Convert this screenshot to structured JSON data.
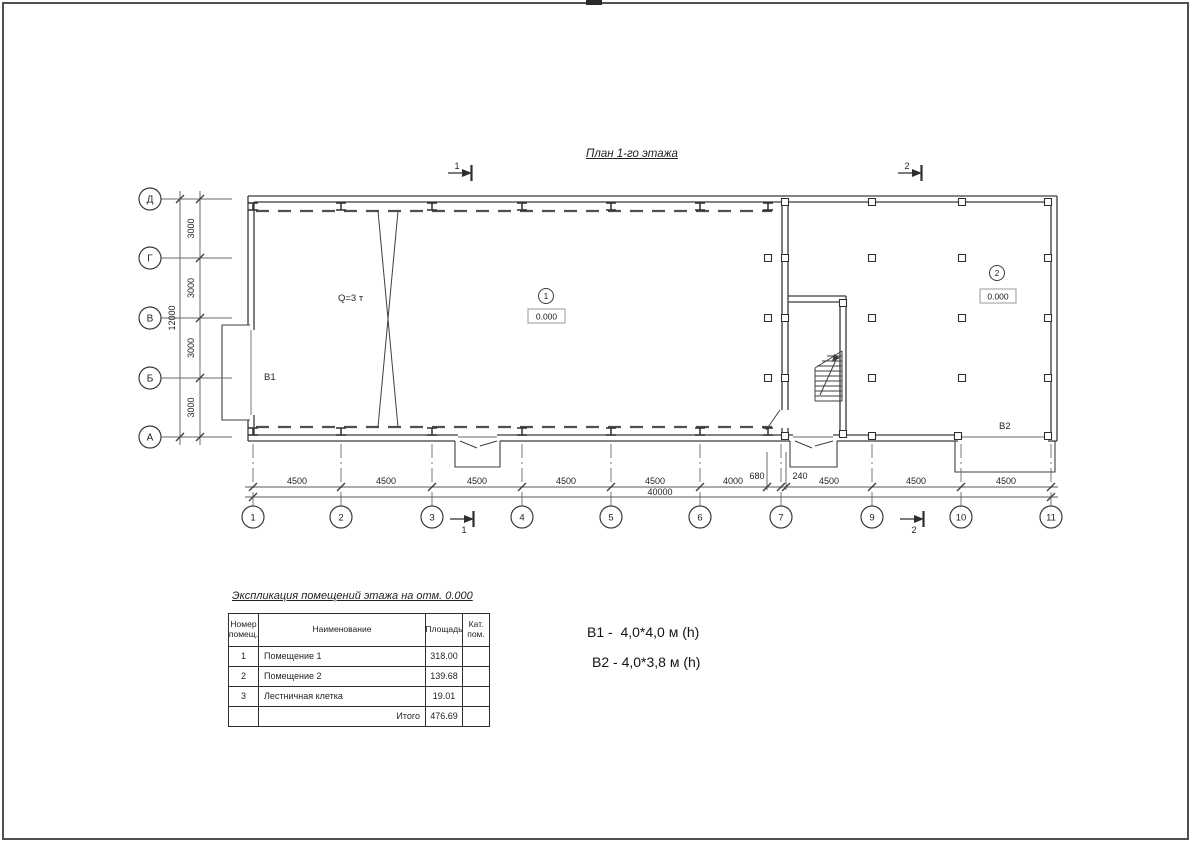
{
  "sheet": {
    "title": "План 1-го этажа"
  },
  "axes": {
    "rows": [
      "Д",
      "Г",
      "В",
      "Б",
      "А"
    ],
    "cols": [
      "1",
      "2",
      "3",
      "4",
      "5",
      "6",
      "7",
      "9",
      "10",
      "11"
    ]
  },
  "dims": {
    "left_segments": [
      "3000",
      "3000",
      "3000",
      "3000"
    ],
    "left_total": "12000",
    "bottom_segments": [
      "4500",
      "4500",
      "4500",
      "4500",
      "4500",
      "4000",
      "680",
      "240",
      "4500",
      "4500",
      "4500"
    ],
    "bottom_total": "40000"
  },
  "plan": {
    "crane_label": "Q=3 т",
    "gate1_label": "В1",
    "gate2_label": "В2",
    "room1": {
      "num": "1",
      "elev": "0.000"
    },
    "room2": {
      "num": "2",
      "elev": "0.000"
    },
    "sections": {
      "top1": "1",
      "top2": "2",
      "bottom1": "1",
      "bottom2": "2"
    }
  },
  "legend": {
    "line1": "В1 -  4,0*4,0 м (h)",
    "line2": "В2 - 4,0*3,8 м (h)"
  },
  "table": {
    "title": "Экспликация помещений этажа на отм. 0.000",
    "headers": {
      "col1": "Номер\nпомещ.",
      "col2": "Наименование",
      "col3": "Площадь",
      "col4": "Кат.\nпом."
    },
    "rows": [
      {
        "num": "1",
        "name": "Помещение 1",
        "area": "318.00",
        "cat": ""
      },
      {
        "num": "2",
        "name": "Помещение 2",
        "area": "139.68",
        "cat": ""
      },
      {
        "num": "3",
        "name": "Лестничная клетка",
        "area": "19.01",
        "cat": ""
      }
    ],
    "total_label": "Итого",
    "total_value": "476.69"
  }
}
